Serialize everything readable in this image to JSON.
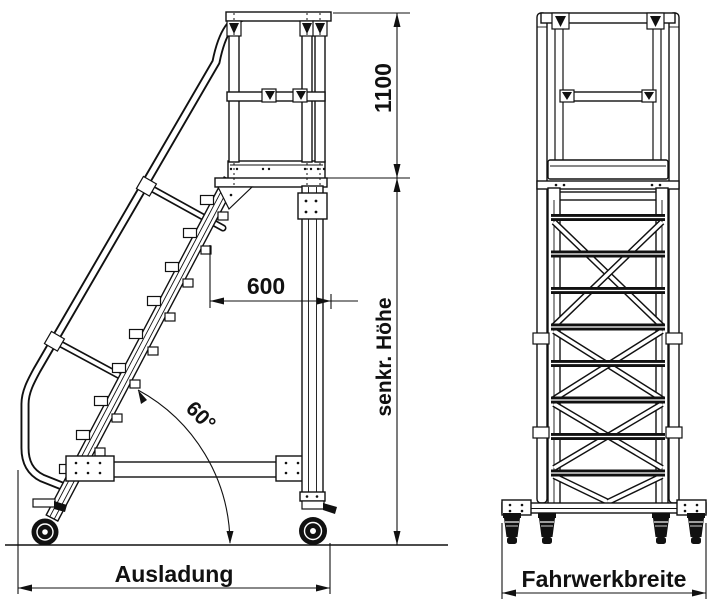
{
  "dimensions": {
    "guardrail_height": "1100",
    "platform_depth": "600",
    "stair_angle": "60°",
    "vertical_height": "senkr. Höhe",
    "outreach": "Ausladung",
    "chassis_width": "Fahrwerkbreite"
  }
}
